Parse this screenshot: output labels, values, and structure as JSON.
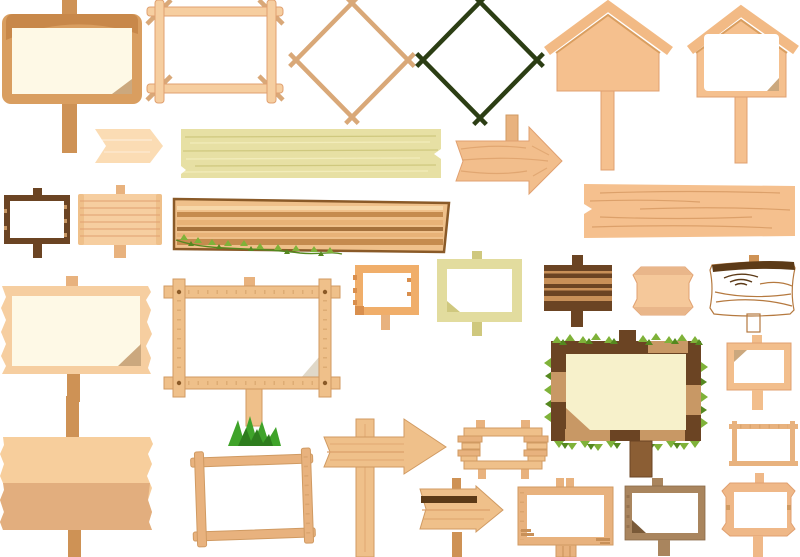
{
  "page": {
    "title": "Blank wooden sign boards, frames and signposts — clip-art collection",
    "background": "#FFFFFF"
  },
  "colors": {
    "bg": "#FFFFFF",
    "white": "#FFFFFF",
    "cream": "#FEF9E6",
    "cream2": "#F7F1CB",
    "peach_light": "#FBDCB4",
    "peach": "#F5C08E",
    "peach_edge": "#E0A070",
    "peach_frame": "#F2BE8C",
    "tan_light": "#F6CEA0",
    "wood_mid": "#EFC08A",
    "wood_edge": "#D09A62",
    "orange_frame": "#F0AE6A",
    "khaki": "#E7E0A4",
    "khaki_frame": "#E2DC9E",
    "khaki_dark": "#CFC87E",
    "khaki_light": "#F2ECBA",
    "brown_dark": "#6B4423",
    "gray_brown": "#A9855E",
    "post": "#CE9255",
    "tan_patch": "#C89865",
    "stripe_tan": "#C89058",
    "log": "#F2C494",
    "log_grain": "#B5793F",
    "dark_line": "#5C3A17",
    "grain": "#DCA06A",
    "stick_tan": "#D9A878",
    "stick_green": "#2C3E14",
    "roof": "#F2BA85",
    "frame_main": "#D99E60",
    "frame_shadow": "#C8884A",
    "frame_tan": "#E8B27E",
    "leaf": "#7FB239",
    "leaf_dark": "#55881F",
    "grass": "#3FA32A",
    "grass_dark": "#2E7D1E",
    "fold": "#CBA87E",
    "fold_light": "#E0D8C8",
    "banner_top": "#F7CE9C",
    "banner_bottom": "#E2AE7E"
  },
  "items": [
    {
      "id": "framed-sign-on-post",
      "label": "Rounded sign board on post with folded corner"
    },
    {
      "id": "stick-square-frame",
      "label": "Square stick frame"
    },
    {
      "id": "stick-diamond-tan",
      "label": "Tan diamond stick frame"
    },
    {
      "id": "stick-diamond-green",
      "label": "Dark green diamond stick frame"
    },
    {
      "id": "house-sign-solid",
      "label": "House-shaped sign on post"
    },
    {
      "id": "house-sign-panel",
      "label": "House-shaped sign with white panel on post"
    },
    {
      "id": "pennant-arrow",
      "label": "Chevron pennant sign"
    },
    {
      "id": "khaki-plank",
      "label": "Pale khaki wooden plank"
    },
    {
      "id": "arrow-sign-grained",
      "label": "Wood-grain arrow sign with post stub"
    },
    {
      "id": "long-plank-right",
      "label": "Long peach wooden plank"
    },
    {
      "id": "dark-framed-small-sign",
      "label": "Small dark-framed sign with posts"
    },
    {
      "id": "slatted-small-sign",
      "label": "Small slatted sign with posts"
    },
    {
      "id": "striped-plank-vine",
      "label": "Striped wooden plank with ivy vine"
    },
    {
      "id": "small-stick-framed-sign",
      "label": "Small stick-framed sign on post"
    },
    {
      "id": "khaki-framed-sign",
      "label": "Khaki framed sign with posts"
    },
    {
      "id": "brown-slatted-sign",
      "label": "Dark brown slatted sign with posts"
    },
    {
      "id": "beveled-panel-sign",
      "label": "Beveled octagonal wooden panel"
    },
    {
      "id": "log-sign",
      "label": "Rough log sign with knots on post"
    },
    {
      "id": "torn-edge-sign",
      "label": "Torn-edge sign with cream face on post"
    },
    {
      "id": "crossed-plank-frame-sign",
      "label": "Crossed-plank framed sign on post with grass tuft"
    },
    {
      "id": "tilted-stick-frame-sign",
      "label": "Tilted stick-framed sign"
    },
    {
      "id": "two-tone-banner-sign",
      "label": "Two-tone torn banner on tall post"
    },
    {
      "id": "arrow-signpost",
      "label": "Tall signpost with arrow plank"
    },
    {
      "id": "rough-slat-framed-sign",
      "label": "Rough slat-framed sign with pegs"
    },
    {
      "id": "striped-arrow-sign",
      "label": "Striped arrow sign on post"
    },
    {
      "id": "slat-framed-sign-post",
      "label": "Slat-framed sign on wide post"
    },
    {
      "id": "brown-framed-sign-post",
      "label": "Brown framed sign with folded corner on post"
    },
    {
      "id": "corner-tab-framed-sign",
      "label": "Corner-tab framed sign on posts"
    },
    {
      "id": "peach-framed-sign-post",
      "label": "Peach framed sign on post"
    },
    {
      "id": "thin-stick-framed-sign",
      "label": "Thin stick-framed sign"
    },
    {
      "id": "ivy-framed-sign",
      "label": "Ivy-decorated patchwork framed sign on post"
    }
  ]
}
